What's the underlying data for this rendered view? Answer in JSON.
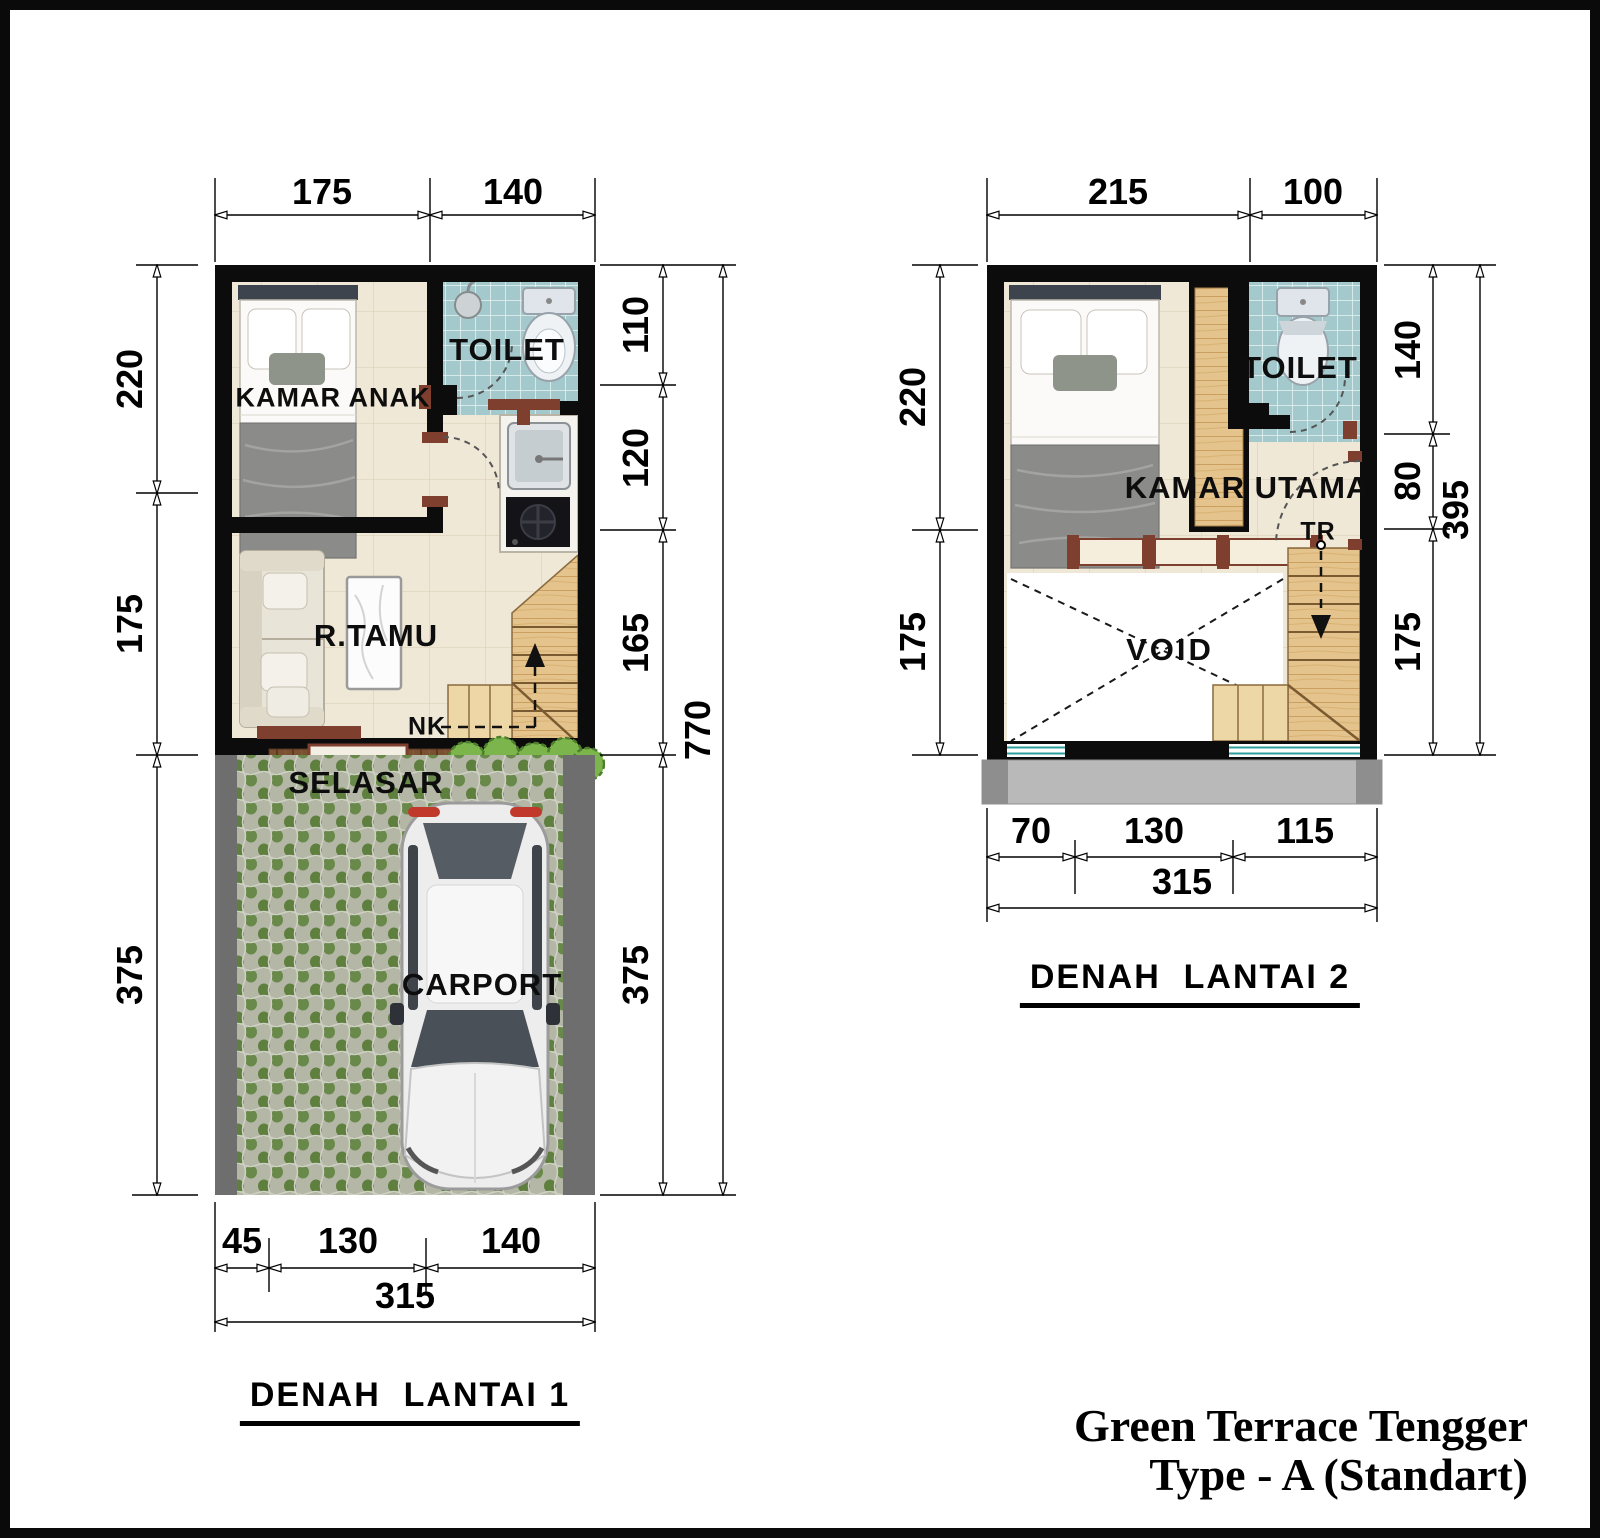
{
  "project": {
    "line1": "Green Terrace Tengger",
    "line2": "Type - A (Standart)"
  },
  "floor1": {
    "title": "DENAH  LANTAI 1",
    "rooms": {
      "bedroom": "KAMAR ANAK",
      "toilet": "TOILET",
      "living": "R.TAMU",
      "entry": "NK",
      "porch": "SELASAR",
      "carport": "CARPORT"
    },
    "dims": {
      "top": [
        "175",
        "140"
      ],
      "left": [
        "220",
        "175",
        "375"
      ],
      "right": [
        "110",
        "120",
        "165",
        "375"
      ],
      "right_total": "770",
      "bottom": [
        "45",
        "130",
        "140"
      ],
      "bottom_total": "315"
    }
  },
  "floor2": {
    "title": "DENAH  LANTAI 2",
    "rooms": {
      "bedroom": "KAMAR UTAMA",
      "toilet": "TOILET",
      "stairs": "TR",
      "void": "VOID"
    },
    "dims": {
      "top": [
        "215",
        "100"
      ],
      "left": [
        "220",
        "175"
      ],
      "right": [
        "140",
        "80",
        "175"
      ],
      "right_total": "395",
      "bottom": [
        "70",
        "130",
        "115"
      ],
      "bottom_total": "315"
    }
  }
}
